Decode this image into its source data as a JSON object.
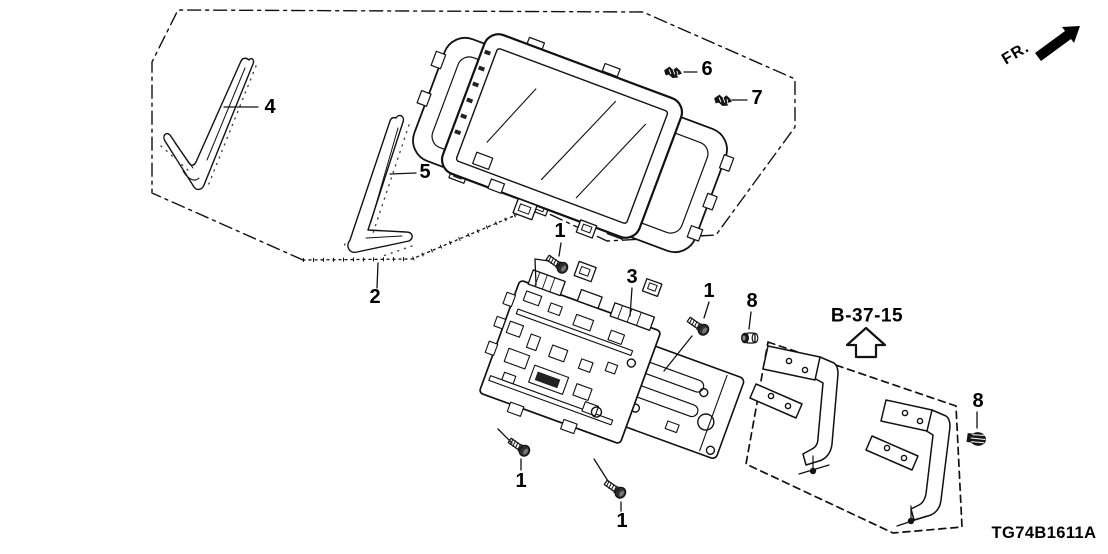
{
  "diagram": {
    "direction_indicator": "FR.",
    "reference_code": "B-37-15",
    "catalog_code": "TG74B1611A"
  },
  "callouts": {
    "screw_top": "1",
    "screw_right": "1",
    "screw_bottom_left": "1",
    "screw_bottom_center": "1",
    "panel_assembly": "2",
    "audio_unit": "3",
    "garnish_left": "4",
    "garnish_center": "5",
    "small_screw_upper": "6",
    "small_screw_lower": "7",
    "bolt_left": "8",
    "bolt_right": "8"
  }
}
